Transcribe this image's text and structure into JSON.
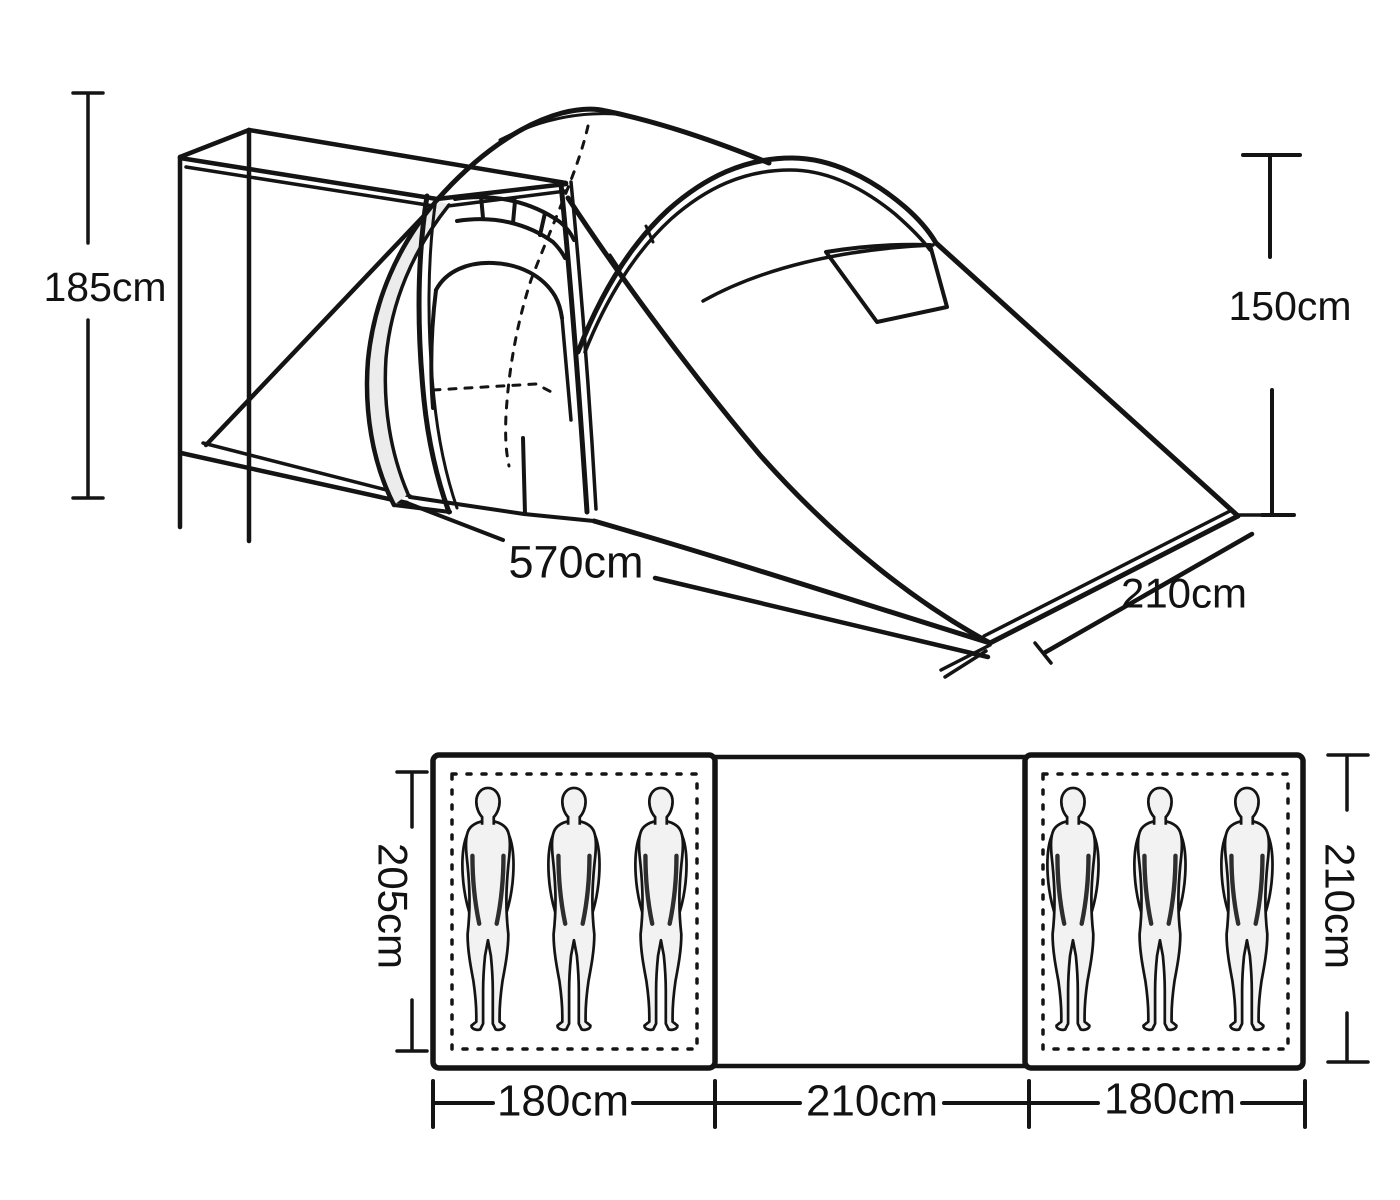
{
  "diagram": {
    "title": "tent-dimension-diagram",
    "units": "cm",
    "perspective": {
      "porch_height": "185cm",
      "inner_height": "150cm",
      "length": "570cm",
      "depth": "210cm"
    },
    "floorplan": {
      "left_bedroom": {
        "width": "180cm",
        "depth": "205cm",
        "sleepers": 3
      },
      "living_area": {
        "width": "210cm"
      },
      "right_bedroom": {
        "width": "180cm",
        "depth": "210cm",
        "sleepers": 3
      }
    },
    "colors": {
      "line": "#141414",
      "background": "#ffffff",
      "figure_fill": "#f2f2f2",
      "figure_shade": "#2e2e2e"
    }
  }
}
